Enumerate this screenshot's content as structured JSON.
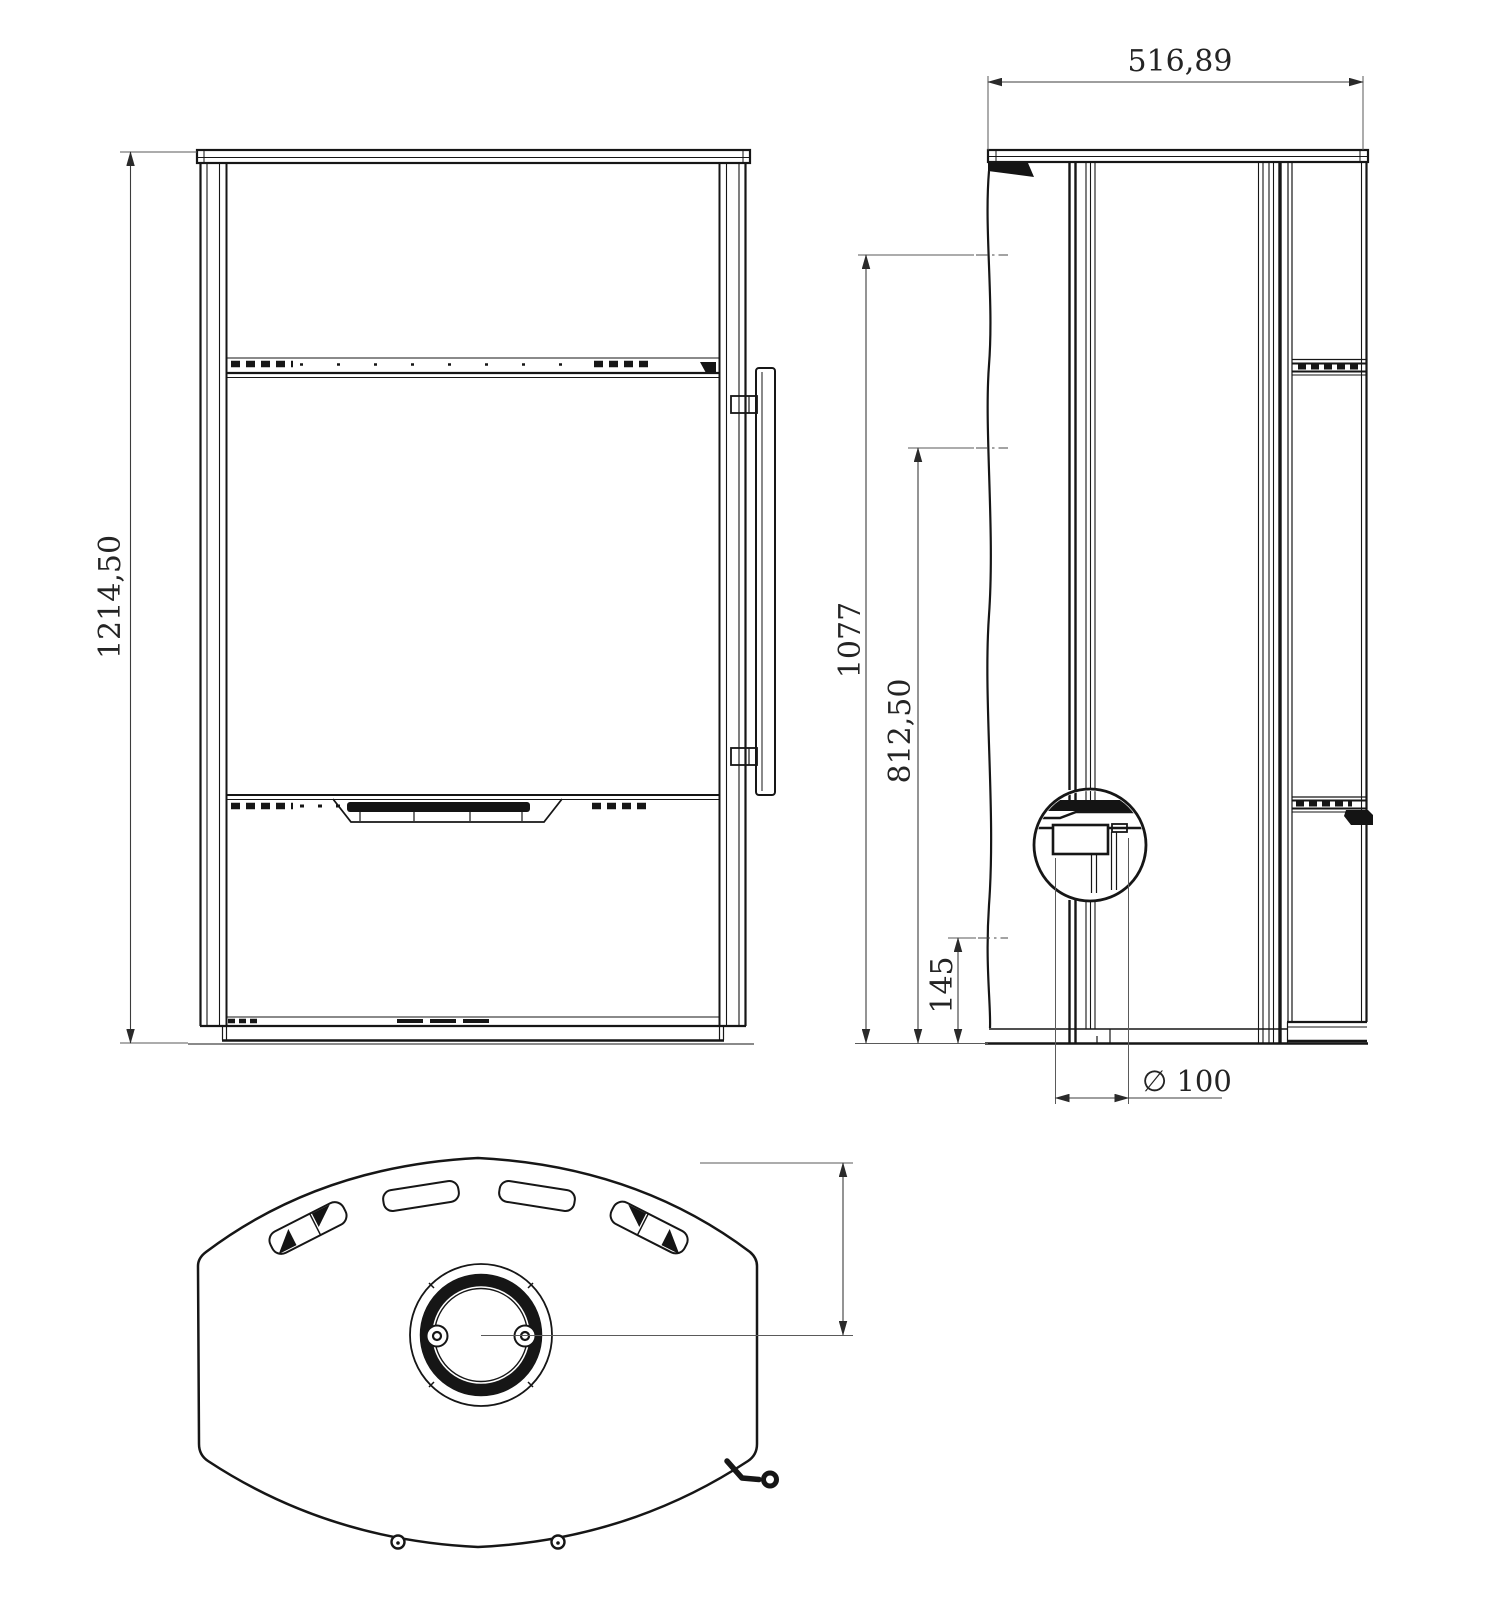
{
  "drawing": {
    "type": "technical-drawing",
    "views": {
      "front": "front-view",
      "side": "side-view",
      "top": "top-view"
    },
    "colors": {
      "line": "#161616",
      "dimension": "#3c3c3c",
      "background": "#ffffff"
    }
  },
  "dimensions": {
    "overall_height": "1214,50",
    "depth": "516,89",
    "flue_center_height": "1077",
    "rear_outlet_height": "812,50",
    "intake_height": "145",
    "intake_diameter": "∅ 100",
    "flue_center_offset": "233,24"
  }
}
